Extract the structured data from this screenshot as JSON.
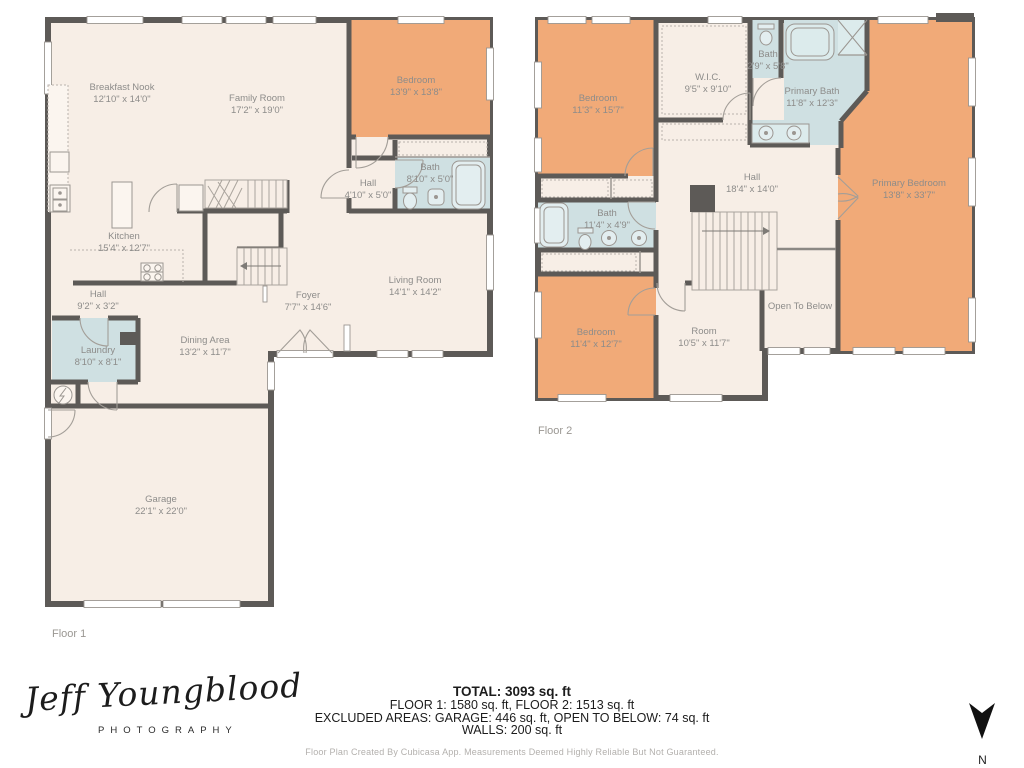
{
  "colors": {
    "wall": "#5d5a57",
    "floor": "#f7eee6",
    "room_orange": "#f1aa78",
    "room_blue": "#cfe0e2",
    "label_gray": "#8d8c8a",
    "footer_text": "#1c1c1c",
    "muted_gray": "#b3b0ad"
  },
  "floor1": {
    "caption": "Floor 1",
    "rooms": {
      "breakfast_nook": {
        "name": "Breakfast Nook",
        "dims": "12'10\" x 14'0\""
      },
      "family_room": {
        "name": "Family Room",
        "dims": "17'2\" x 19'0\""
      },
      "bedroom": {
        "name": "Bedroom",
        "dims": "13'9\" x 13'8\""
      },
      "bath": {
        "name": "Bath",
        "dims": "8'10\" x 5'0\""
      },
      "hall": {
        "name": "Hall",
        "dims": "4'10\" x 5'0\""
      },
      "kitchen": {
        "name": "Kitchen",
        "dims": "15'4\" x 12'7\""
      },
      "hall2": {
        "name": "Hall",
        "dims": "9'2\" x 3'2\""
      },
      "foyer": {
        "name": "Foyer",
        "dims": "7'7\" x 14'6\""
      },
      "living_room": {
        "name": "Living Room",
        "dims": "14'1\" x 14'2\""
      },
      "dining_area": {
        "name": "Dining Area",
        "dims": "13'2\" x 11'7\""
      },
      "laundry": {
        "name": "Laundry",
        "dims": "8'10\" x 8'1\""
      },
      "garage": {
        "name": "Garage",
        "dims": "22'1\" x 22'0\""
      }
    }
  },
  "floor2": {
    "caption": "Floor 2",
    "rooms": {
      "bedroom_tl": {
        "name": "Bedroom",
        "dims": "11'3\" x 15'7\""
      },
      "wic": {
        "name": "W.I.C.",
        "dims": "9'5\" x 9'10\""
      },
      "bath_small": {
        "name": "Bath",
        "dims": "2'9\" x 5'8\""
      },
      "primary_bath": {
        "name": "Primary Bath",
        "dims": "11'8\" x 12'3\""
      },
      "primary_bedroom": {
        "name": "Primary Bedroom",
        "dims": "13'8\" x 33'7\""
      },
      "hall": {
        "name": "Hall",
        "dims": "18'4\" x 14'0\""
      },
      "bath": {
        "name": "Bath",
        "dims": "11'4\" x 4'9\""
      },
      "bedroom_bl": {
        "name": "Bedroom",
        "dims": "11'4\" x 12'7\""
      },
      "room": {
        "name": "Room",
        "dims": "10'5\" x 11'7\""
      },
      "open_to_below": {
        "name": "Open To Below"
      }
    }
  },
  "footer": {
    "total": "TOTAL: 3093 sq. ft",
    "floors": "FLOOR 1: 1580 sq. ft, FLOOR 2: 1513 sq. ft",
    "excluded": "EXCLUDED AREAS: GARAGE: 446 sq. ft, OPEN TO BELOW: 74 sq. ft",
    "walls": "WALLS: 200 sq. ft",
    "disclaimer": "Floor Plan Created By Cubicasa App. Measurements Deemed Highly Reliable But Not Guaranteed."
  },
  "logo": {
    "name": "Jeff Youngblood",
    "subtitle": "PHOTOGRAPHY"
  },
  "compass": {
    "label": "N"
  }
}
